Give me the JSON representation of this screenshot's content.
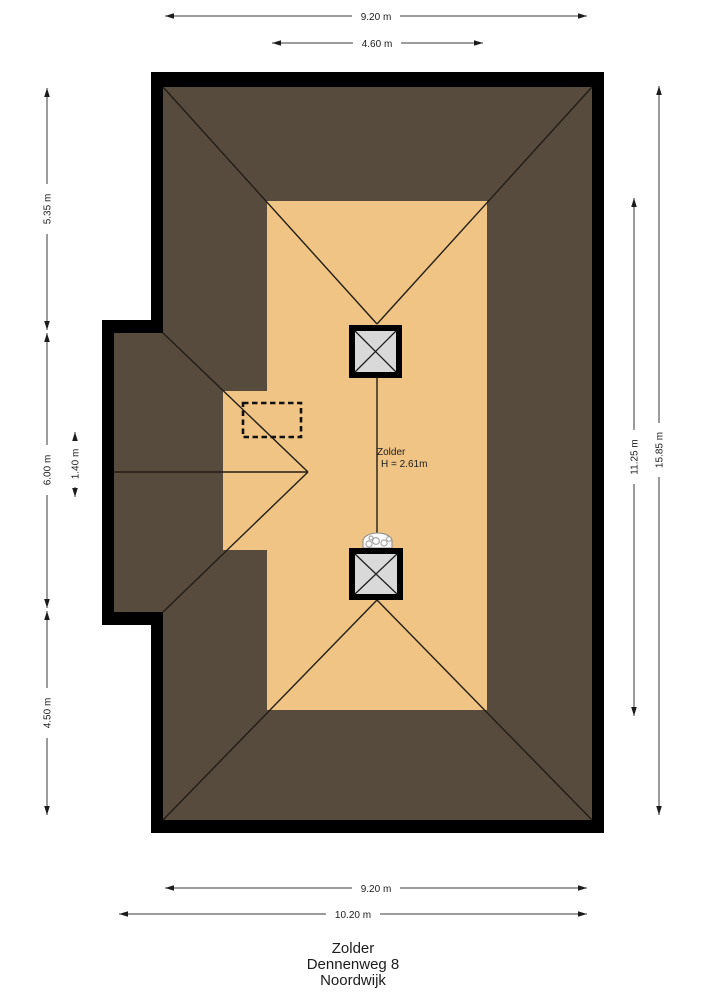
{
  "plan": {
    "room": {
      "name": "Zolder",
      "height": "H = 2.61m"
    }
  },
  "dimensions": {
    "top": [
      "9.20 m",
      "4.60 m"
    ],
    "left": [
      "5.35 m",
      "6.00 m",
      "1.40 m",
      "4.50 m"
    ],
    "right": [
      "11.25 m",
      "15.85 m"
    ],
    "bottom": [
      "9.20 m",
      "10.20 m"
    ]
  },
  "title": {
    "line1": "Zolder",
    "line2": "Dennenweg 8",
    "line3": "Noordwijk"
  },
  "colors": {
    "outline": "#000000",
    "roof": "#564b3d",
    "floor": "#f0c484",
    "chimney_fill": "#d9d9d9",
    "line": "#231d15",
    "dim_line": "#3a3a3a"
  }
}
